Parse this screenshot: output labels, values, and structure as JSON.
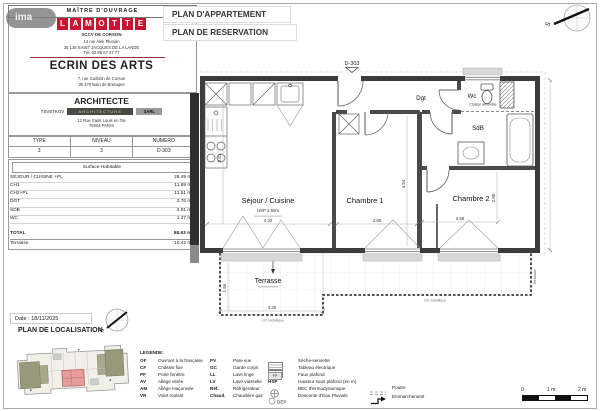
{
  "watermark": {
    "text": "ima"
  },
  "header": {
    "mo_label": "MAÎTRE D'OUVRAGE",
    "company": "SCCV DE CORSON",
    "address1": "14 rue Alek Plunian",
    "address2": "35 136 SAINT JACQUES DE LA LANDE",
    "phone": "Tél. 02 99 67 27 77",
    "project_name": "ECRIN DES ARTS",
    "project_address1": "7, rue Guillotin de Corson",
    "project_address2": "35 470 Bain de Bretagne"
  },
  "brand": {
    "letters": [
      "L",
      "A",
      "M",
      "O",
      "T",
      "T",
      "E"
    ],
    "color": "#c81431"
  },
  "titles": {
    "title1": "PLAN D'APPARTEMENT",
    "title2": "PLAN DE RESERVATION"
  },
  "architect": {
    "heading": "ARCHITECTE",
    "name": "TSVETKOV",
    "band": "ARCHITECTURE",
    "suffix": "SARL",
    "address1": "12 Rue Saint Louis en l'Ile",
    "address2": "75004 PARIS"
  },
  "unit_table": {
    "headers": [
      "TYPE",
      "NIVEAU",
      "NUMERO"
    ],
    "values": [
      "3",
      "3",
      "D-303"
    ]
  },
  "surface_table": {
    "title": "Surface Habitable",
    "rows": [
      {
        "label": "SÉJOUR / CUISINE +PL",
        "value": "26.49 m²"
      },
      {
        "label": "CH1",
        "value": "11.69 m²"
      },
      {
        "label": "CH2+PL",
        "value": "11.51 m²"
      },
      {
        "label": "DGT",
        "value": "3.76 m²"
      },
      {
        "label": "SDB",
        "value": "3.91 m²"
      },
      {
        "label": "WC",
        "value": "1.27 m²"
      }
    ],
    "total": {
      "label": "TOTAL",
      "value": "58.63 m²"
    },
    "terrace": {
      "label": "Terrasse",
      "value": "10.42 m²"
    }
  },
  "plan": {
    "unit_label": "D-303",
    "rooms": {
      "sejour": "Séjour / Cuisine",
      "hsp": "HSP 2.50m",
      "ch1": "Chambre 1",
      "ch2": "Chambre 2",
      "dgt": "Dgt",
      "wc": "Wc",
      "cloison": "Cloison amovible",
      "sdb": "SdB",
      "terrasse": "Terrasse",
      "gc_note": "GC métallique"
    },
    "dims": {
      "sejour_w": "4.32",
      "sejour_h": "3.81",
      "ch1_w": "2.80",
      "ch1_h": "4.54",
      "ch2_w": "3.58",
      "ch2_h": "2.80",
      "terrasse_w": "3.35",
      "terrasse_h": "1.66"
    },
    "compass": "S"
  },
  "footer": {
    "date": "Date : 18/11/2025",
    "localisation_title": "PLAN DE LOCALISATION"
  },
  "legend": {
    "title": "LEGENDE:",
    "col1": [
      {
        "abbr": "OF",
        "label": "Ouvrant à la française"
      },
      {
        "abbr": "CF",
        "label": "Châssis fixe"
      },
      {
        "abbr": "PF",
        "label": "Porte fenêtre"
      },
      {
        "abbr": "AV",
        "label": "Allège vitrée"
      },
      {
        "abbr": "AM",
        "label": "Allège maçonnée"
      },
      {
        "abbr": "VR",
        "label": "Volet roulant"
      }
    ],
    "col2": [
      {
        "abbr": "PV",
        "label": "Pare vue"
      },
      {
        "abbr": "GC",
        "label": "Garde corps"
      },
      {
        "abbr": "LL",
        "label": "Lave linge"
      },
      {
        "abbr": "LV",
        "label": "Lave vaisselle"
      },
      {
        "abbr": "Réf.",
        "label": "Réfrigérateur"
      },
      {
        "abbr": "Chaud.",
        "label": "Chaudière gaz"
      }
    ],
    "col3": [
      {
        "abbr": "",
        "label": "Sèche-serviette"
      },
      {
        "abbr": "",
        "label": "Tableau électrique"
      },
      {
        "abbr": "FP",
        "label": "Faux plafond"
      },
      {
        "abbr": "HSP",
        "label": "Hauteur sous plafond (en m)"
      },
      {
        "abbr": "",
        "label": "BEC thermodynamique"
      },
      {
        "abbr": "DEP",
        "label": "Descente d'Eau Pluviale"
      }
    ],
    "col4": [
      {
        "label": "Poutre"
      },
      {
        "label": "Emmarchement"
      }
    ]
  },
  "scalebar": {
    "labels": [
      "0",
      "1 m",
      "2 m"
    ]
  }
}
